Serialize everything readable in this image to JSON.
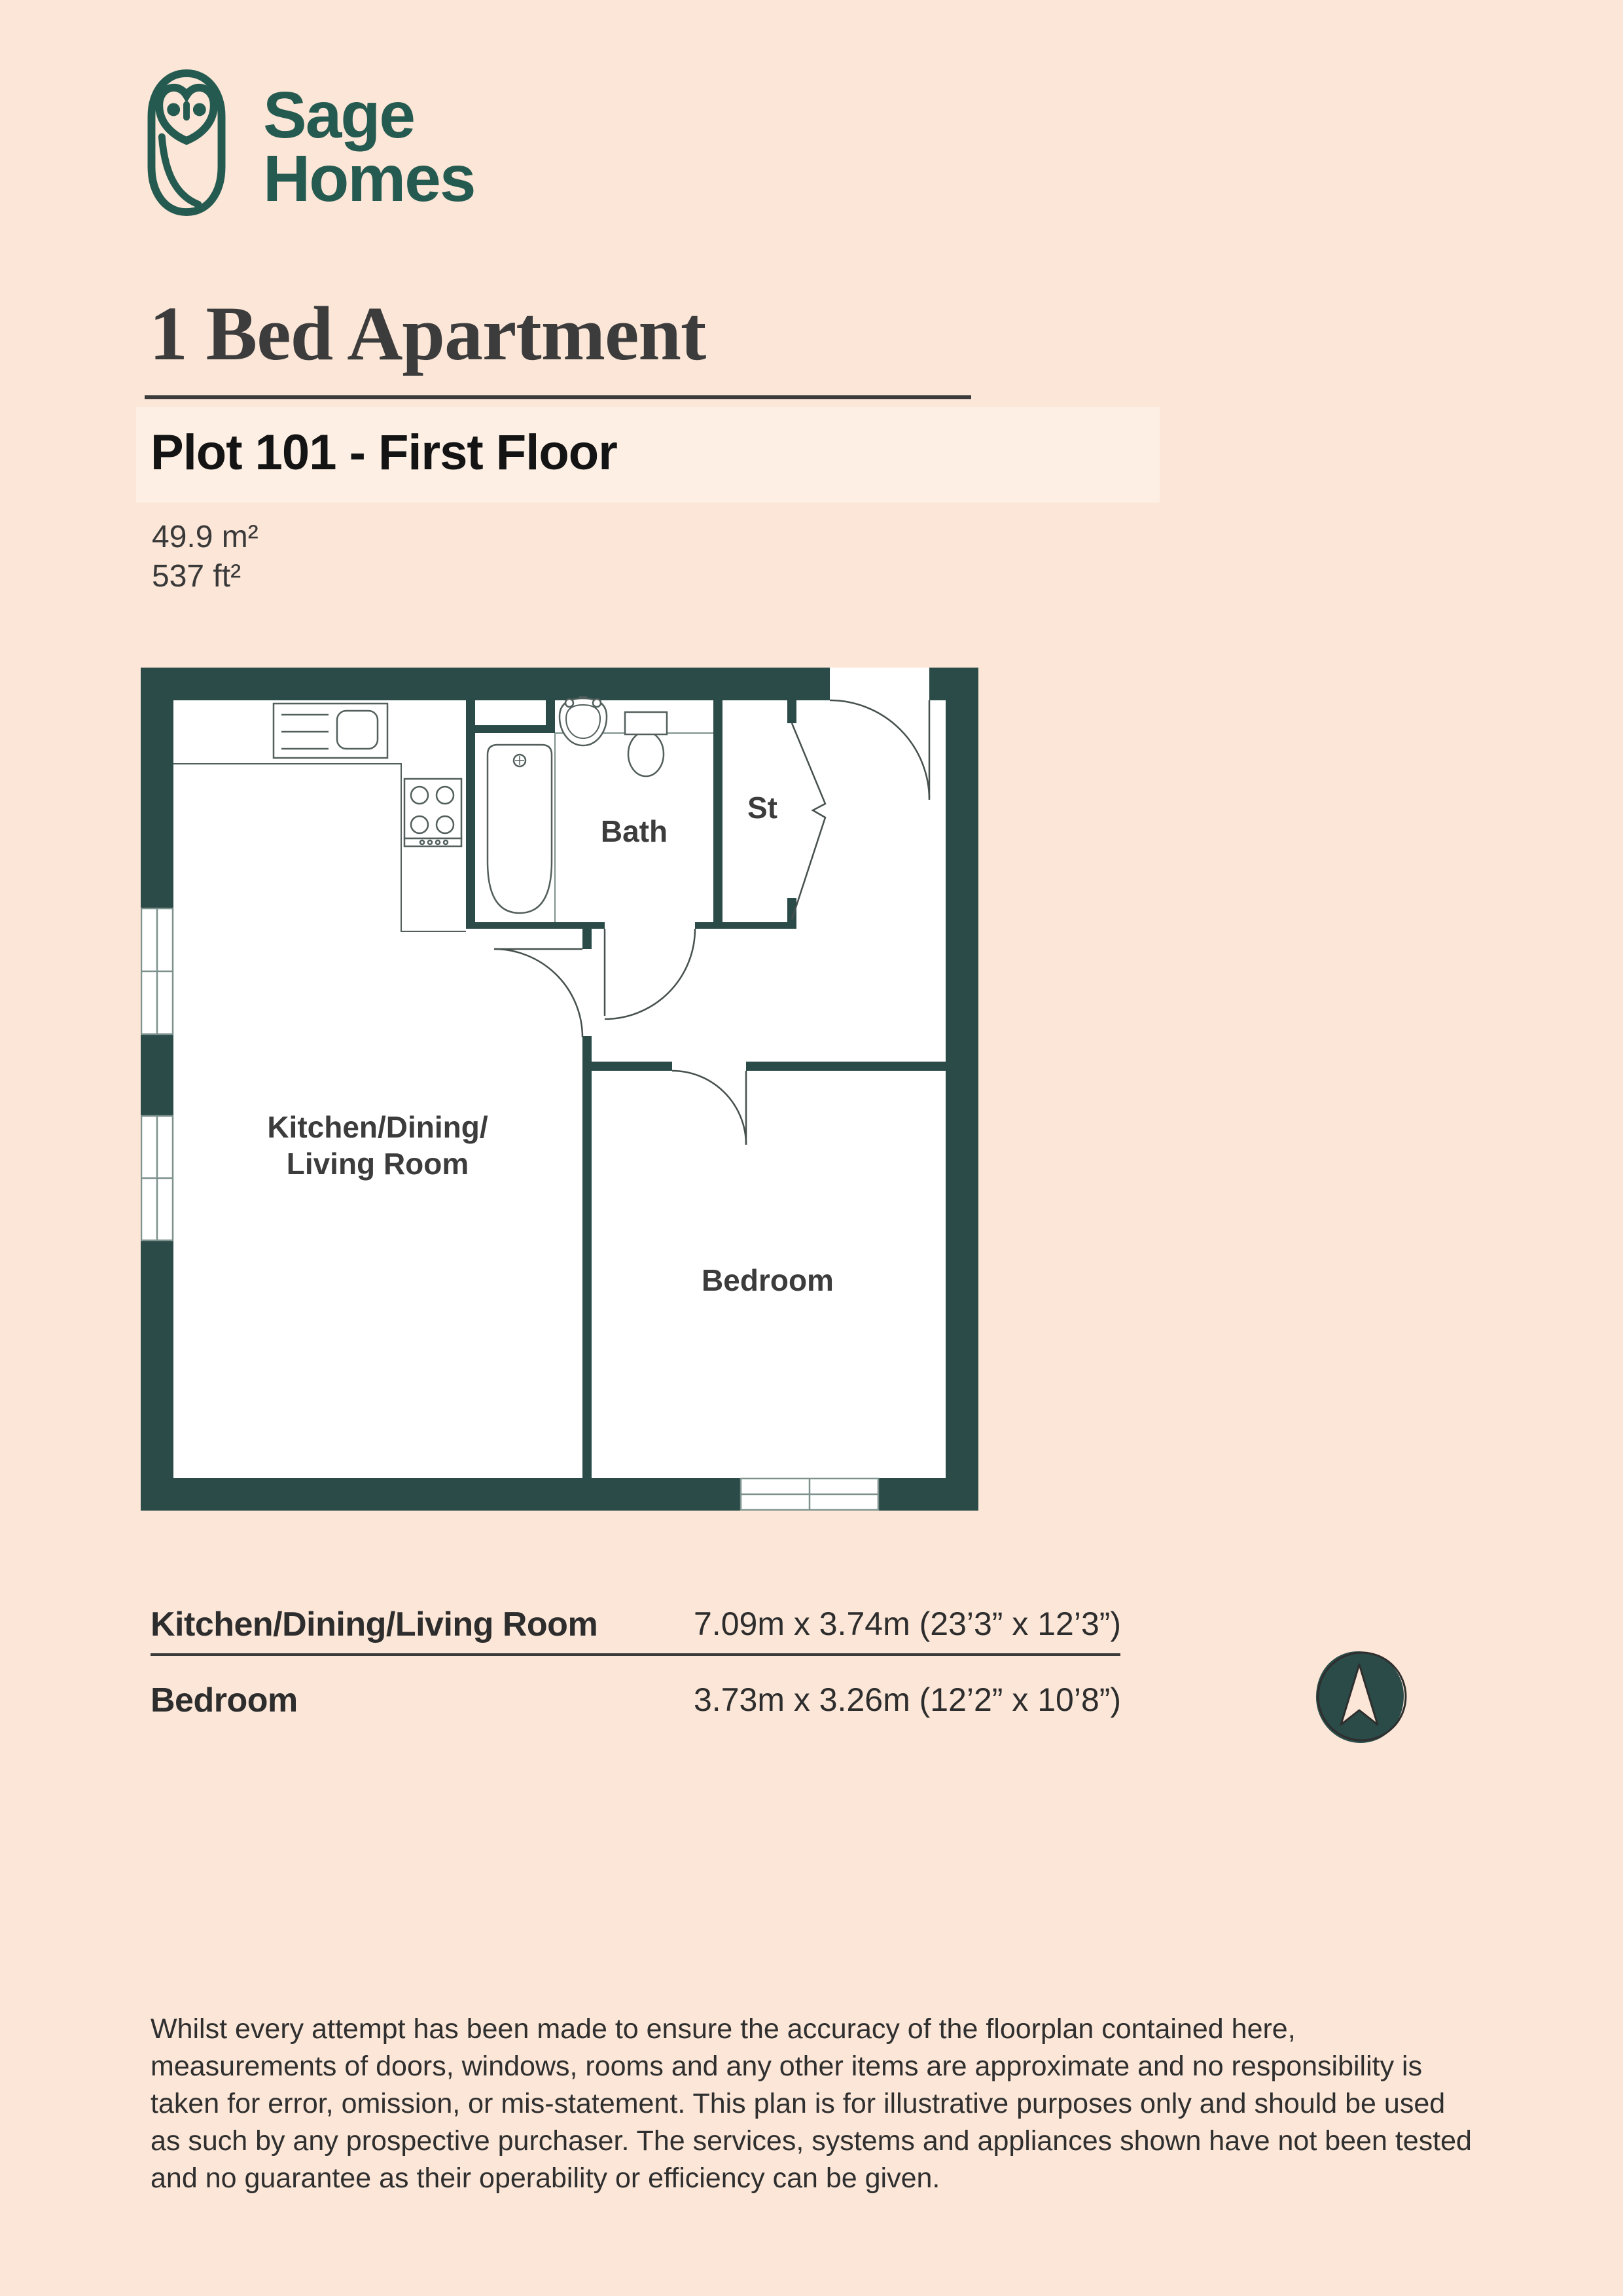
{
  "brand": {
    "line1": "Sage",
    "line2": "Homes"
  },
  "header": {
    "title": "1 Bed Apartment",
    "plot_label": "Plot 101 - First Floor",
    "area_m2": "49.9 m²",
    "area_ft2": "537 ft²"
  },
  "floorplan": {
    "room_labels": {
      "kitchen_line1": "Kitchen/Dining/",
      "kitchen_line2": "Living Room",
      "bath": "Bath",
      "storage": "St",
      "bedroom": "Bedroom"
    }
  },
  "dimensions_table": {
    "rows": [
      {
        "room": "Kitchen/Dining/Living Room",
        "size": "7.09m x 3.74m (23’3” x 12’3”)"
      },
      {
        "room": "Bedroom",
        "size": "3.73m x 3.26m (12’2” x 10’8”)"
      }
    ]
  },
  "disclaimer": {
    "lines": [
      "Whilst every attempt has been made to ensure the accuracy of the floorplan contained here,",
      "measurements of doors, windows, rooms and any other items are approximate and no responsibility is",
      "taken for error, omission, or mis-statement. This plan is for illustrative purposes only and should be used",
      "as such by any prospective purchaser. The services, systems and appliances shown have not been tested",
      "and no guarantee as their operability or efficiency can be given."
    ]
  },
  "colors": {
    "page_bg": "#fbe6d7",
    "highlight_strip": "#fdefe3",
    "wall": "#2a4b48",
    "brand_teal": "#255a50",
    "fixture_stroke": "#525f5c",
    "door_stroke": "#46504e"
  }
}
